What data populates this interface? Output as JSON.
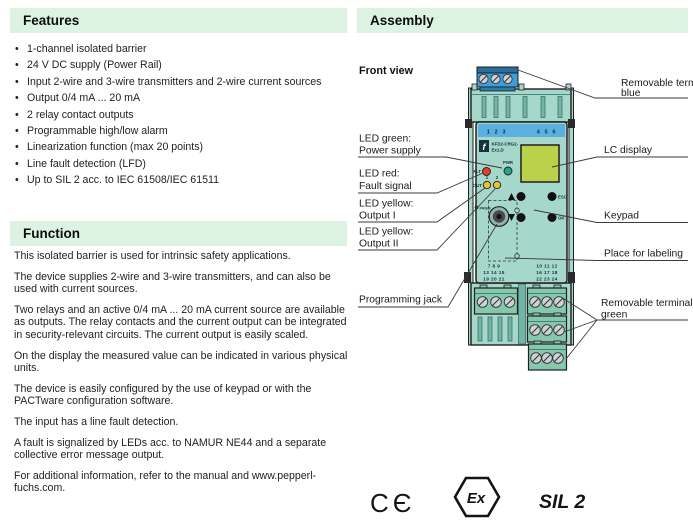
{
  "features": {
    "title": "Features",
    "items": [
      "1-channel isolated barrier",
      "24 V DC supply (Power Rail)",
      "Input 2-wire and 3-wire transmitters and 2-wire current sources",
      "Output 0/4 mA ... 20 mA",
      "2 relay contact outputs",
      "Programmable high/low alarm",
      "Linearization function (max 20 points)",
      "Line fault detection (LFD)",
      "Up to SIL 2 acc. to IEC 61508/IEC 61511"
    ]
  },
  "function": {
    "title": "Function",
    "paragraphs": [
      "This isolated barrier is used for intrinsic safety applications.",
      "The device supplies 2-wire and 3-wire transmitters, and can also be used with current sources.",
      "Two relays and an active 0/4 mA ... 20 mA current source are available as outputs. The relay contacts and the current output can be integrated in security-relevant circuits. The current output is easily scaled.",
      "On the display the measured value can be indicated in various physical units.",
      "The device is easily configured by the use of keypad or with the PACTware configuration software.",
      "The input has a line fault detection.",
      "A fault is signalized by LEDs acc. to NAMUR NE44 and a separate collective error message output.",
      "For additional information, refer to the manual and www.pepperl-fuchs.com."
    ]
  },
  "assembly": {
    "title": "Assembly",
    "front_view": "Front view",
    "callouts_left": {
      "led_green": [
        "LED green:",
        "Power supply"
      ],
      "led_red": [
        "LED red:",
        "Fault signal"
      ],
      "led_yellow_1": [
        "LED yellow:",
        "Output I"
      ],
      "led_yellow_2": [
        "LED yellow:",
        "Output II"
      ],
      "programming_jack": "Programming jack"
    },
    "callouts_right": {
      "terminal_blue": [
        "Removable terminal",
        "blue"
      ],
      "lc_display": "LC display",
      "keypad": "Keypad",
      "labeling": "Place for labeling",
      "terminals_green": [
        "Removable terminals",
        "green"
      ]
    },
    "device": {
      "model": [
        "KFD2-CRG2-",
        "Ex1.D"
      ],
      "logo_glyph": "f",
      "top_numbers": [
        "1 2 3",
        "4 5 6"
      ],
      "leds": {
        "flt": "FLT",
        "pwr": "PWR",
        "out": "OUT",
        "n1": "1",
        "n2": "2"
      },
      "keys": {
        "esc": "ESC",
        "ok": "OK"
      },
      "prgm": "PRGM",
      "terminals_left": [
        "7 8 9",
        "13 14 15",
        "19 20 21"
      ],
      "terminals_right": [
        "10 11 12",
        "16 17 18",
        "22 23 24"
      ]
    },
    "marks": {
      "ce": "CЄ",
      "ex": "Ex",
      "sil": "SIL 2"
    }
  },
  "colors": {
    "header_bg": "#ddf3e1",
    "device_teal": "#a6d7cb",
    "band_blue": "#5cb0e0",
    "terminal_blue": "#3f9fd4",
    "lcd_green": "#bcd14a",
    "led_red": "#e23e2a",
    "led_green": "#27a090",
    "led_yellow": "#eac42c",
    "terminal_green": "#85c8ae"
  }
}
